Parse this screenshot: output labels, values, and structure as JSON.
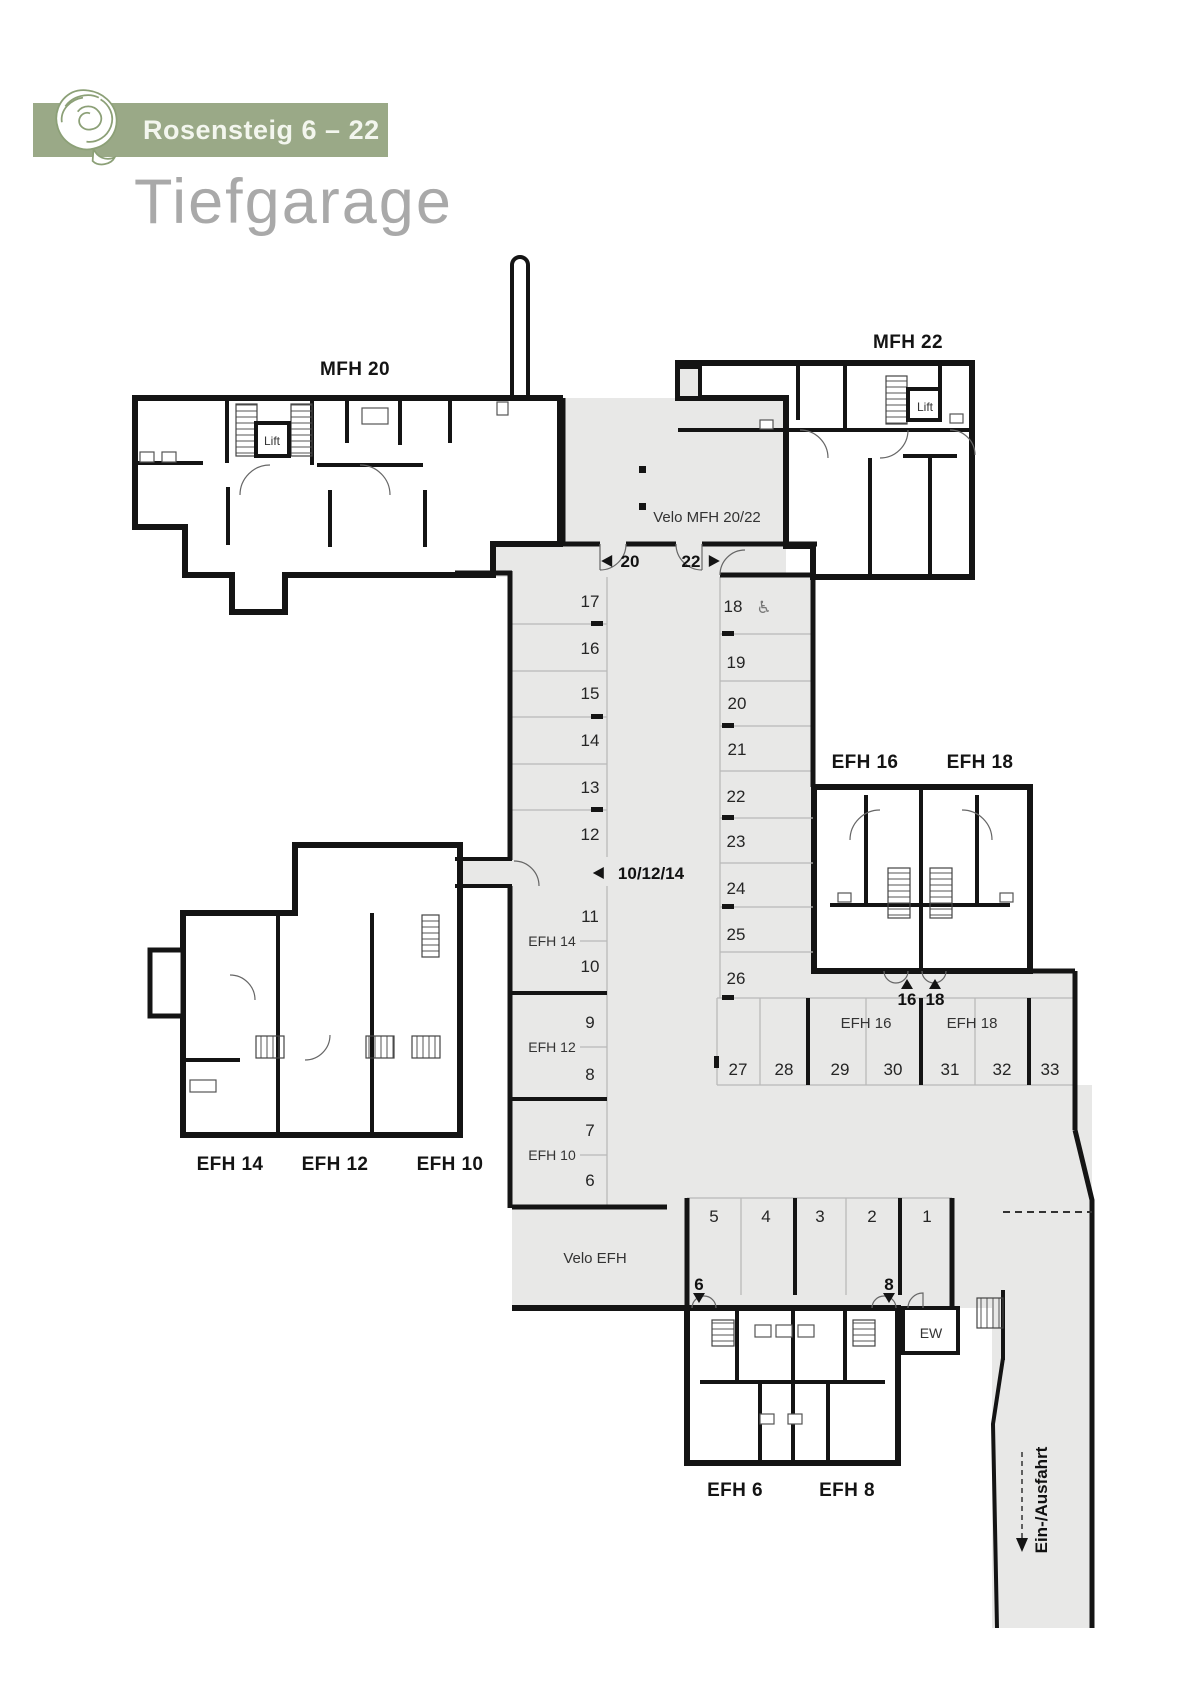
{
  "header": {
    "project": "Rosensteig 6 – 22",
    "page_title": "Tiefgarage",
    "brand_color": "#9aa987",
    "logo": "rose-icon"
  },
  "plan": {
    "colors": {
      "wall": "#141414",
      "floor": "#e8e8e7",
      "stall_line": "#b9b9b9"
    },
    "building_labels": [
      {
        "id": "mfh-20",
        "text": "MFH 20",
        "x": 355,
        "y": 368
      },
      {
        "id": "mfh-22",
        "text": "MFH 22",
        "x": 908,
        "y": 341
      },
      {
        "id": "efh-16",
        "text": "EFH 16",
        "x": 865,
        "y": 761
      },
      {
        "id": "efh-18",
        "text": "EFH 18",
        "x": 980,
        "y": 761
      },
      {
        "id": "efh-14",
        "text": "EFH 14",
        "x": 230,
        "y": 1163
      },
      {
        "id": "efh-12",
        "text": "EFH 12",
        "x": 335,
        "y": 1163
      },
      {
        "id": "efh-10",
        "text": "EFH 10",
        "x": 450,
        "y": 1163
      },
      {
        "id": "efh-6",
        "text": "EFH 6",
        "x": 735,
        "y": 1489
      },
      {
        "id": "efh-8",
        "text": "EFH 8",
        "x": 847,
        "y": 1489
      }
    ],
    "small_labels": [
      {
        "id": "velo-mfh",
        "text": "Velo MFH 20/22",
        "x": 707,
        "y": 517,
        "size": 15
      },
      {
        "id": "velo-efh",
        "text": "Velo EFH",
        "x": 595,
        "y": 1258,
        "size": 15
      },
      {
        "id": "ew",
        "text": "EW",
        "x": 931,
        "y": 1333,
        "size": 14
      },
      {
        "id": "stalls-efh14",
        "text": "EFH 14",
        "x": 552,
        "y": 941,
        "size": 14
      },
      {
        "id": "stalls-efh12",
        "text": "EFH 12",
        "x": 552,
        "y": 1047,
        "size": 14
      },
      {
        "id": "stalls-efh10",
        "text": "EFH 10",
        "x": 552,
        "y": 1155,
        "size": 14
      },
      {
        "id": "stalls-efh16",
        "text": "EFH 16",
        "x": 866,
        "y": 1023,
        "size": 15
      },
      {
        "id": "stalls-efh18",
        "text": "EFH 18",
        "x": 972,
        "y": 1023,
        "size": 15
      },
      {
        "id": "lift-mfh20",
        "text": "Lift",
        "x": 272,
        "y": 440,
        "size": 12
      },
      {
        "id": "lift-mfh22",
        "text": "Lift",
        "x": 925,
        "y": 406,
        "size": 12
      }
    ],
    "markers": [
      {
        "label": "20",
        "dir": "left",
        "cx": 630,
        "cy": 561
      },
      {
        "label": "22",
        "dir": "right",
        "cx": 691,
        "cy": 561
      },
      {
        "label": "10/12/14",
        "dir": "left",
        "cx": 651,
        "cy": 873
      },
      {
        "label": "16",
        "dir": "up",
        "cx": 907,
        "cy": 999
      },
      {
        "label": "18",
        "dir": "up",
        "cx": 935,
        "cy": 999
      },
      {
        "label": "6",
        "dir": "down",
        "cx": 699,
        "cy": 1284
      },
      {
        "label": "8",
        "dir": "down",
        "cx": 889,
        "cy": 1284
      }
    ],
    "stalls": [
      {
        "n": "17",
        "x": 590,
        "y": 601
      },
      {
        "n": "16",
        "x": 590,
        "y": 648
      },
      {
        "n": "15",
        "x": 590,
        "y": 693
      },
      {
        "n": "14",
        "x": 590,
        "y": 740
      },
      {
        "n": "13",
        "x": 590,
        "y": 787
      },
      {
        "n": "12",
        "x": 590,
        "y": 834
      },
      {
        "n": "11",
        "x": 590,
        "y": 916
      },
      {
        "n": "10",
        "x": 590,
        "y": 966
      },
      {
        "n": "9",
        "x": 590,
        "y": 1022
      },
      {
        "n": "8",
        "x": 590,
        "y": 1074
      },
      {
        "n": "7",
        "x": 590,
        "y": 1130
      },
      {
        "n": "6",
        "x": 590,
        "y": 1180
      },
      {
        "n": "18",
        "x": 733,
        "y": 606
      },
      {
        "n": "19",
        "x": 736,
        "y": 662
      },
      {
        "n": "20",
        "x": 737,
        "y": 703
      },
      {
        "n": "21",
        "x": 737,
        "y": 749
      },
      {
        "n": "22",
        "x": 736,
        "y": 796
      },
      {
        "n": "23",
        "x": 736,
        "y": 841
      },
      {
        "n": "24",
        "x": 736,
        "y": 888
      },
      {
        "n": "25",
        "x": 736,
        "y": 934
      },
      {
        "n": "26",
        "x": 736,
        "y": 978
      },
      {
        "n": "27",
        "x": 738,
        "y": 1069
      },
      {
        "n": "28",
        "x": 784,
        "y": 1069
      },
      {
        "n": "29",
        "x": 840,
        "y": 1069
      },
      {
        "n": "30",
        "x": 893,
        "y": 1069
      },
      {
        "n": "31",
        "x": 950,
        "y": 1069
      },
      {
        "n": "32",
        "x": 1002,
        "y": 1069
      },
      {
        "n": "33",
        "x": 1050,
        "y": 1069
      },
      {
        "n": "5",
        "x": 714,
        "y": 1216
      },
      {
        "n": "4",
        "x": 766,
        "y": 1216
      },
      {
        "n": "3",
        "x": 820,
        "y": 1216
      },
      {
        "n": "2",
        "x": 872,
        "y": 1216
      },
      {
        "n": "1",
        "x": 927,
        "y": 1216
      }
    ],
    "accessible_stall": {
      "number": "18",
      "icon": "wheelchair-icon",
      "glyph": "♿",
      "x": 764,
      "y": 607
    },
    "ramp": {
      "label": "Ein-/Ausfahrt",
      "x": 1047,
      "y": 1500,
      "rotation": -90
    }
  }
}
